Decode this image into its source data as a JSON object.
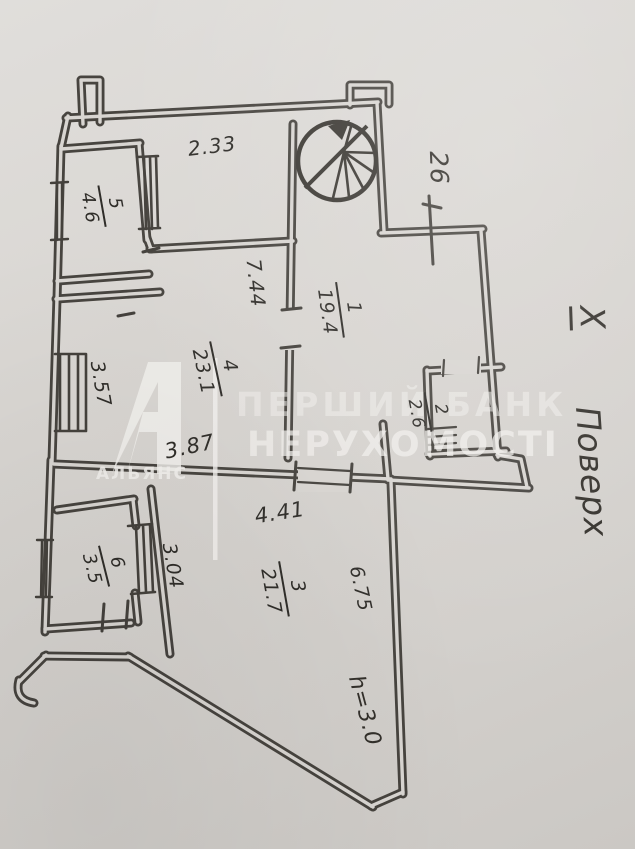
{
  "document": {
    "kind": "scanned apartment floor plan",
    "floor_note": {
      "mark": "X",
      "word": "Поверх"
    },
    "wall_mark": "26",
    "height_note": "h=3.0"
  },
  "rooms": [
    {
      "id": "1",
      "area": "19.4"
    },
    {
      "id": "2",
      "area": "2.6"
    },
    {
      "id": "3",
      "area": "21.7"
    },
    {
      "id": "4",
      "area": "23.1"
    },
    {
      "id": "5",
      "area": "4.6"
    },
    {
      "id": "6",
      "area": "3.5"
    }
  ],
  "dimensions": [
    "2.33",
    "7.44",
    "3.57",
    "3.87",
    "4.41",
    "3.04",
    "6.75"
  ],
  "watermark": {
    "agency": "АЛЬЯНС",
    "line1": "ПЕРШИЙ БАНК",
    "line2": "НЕРУХОМОСТІ"
  },
  "icons": {
    "stairs": "spiral-stairs-icon"
  },
  "colors": {
    "paper": "#d8d5d1",
    "ink": "#3b3833",
    "watermark": "#f2f0ed"
  }
}
